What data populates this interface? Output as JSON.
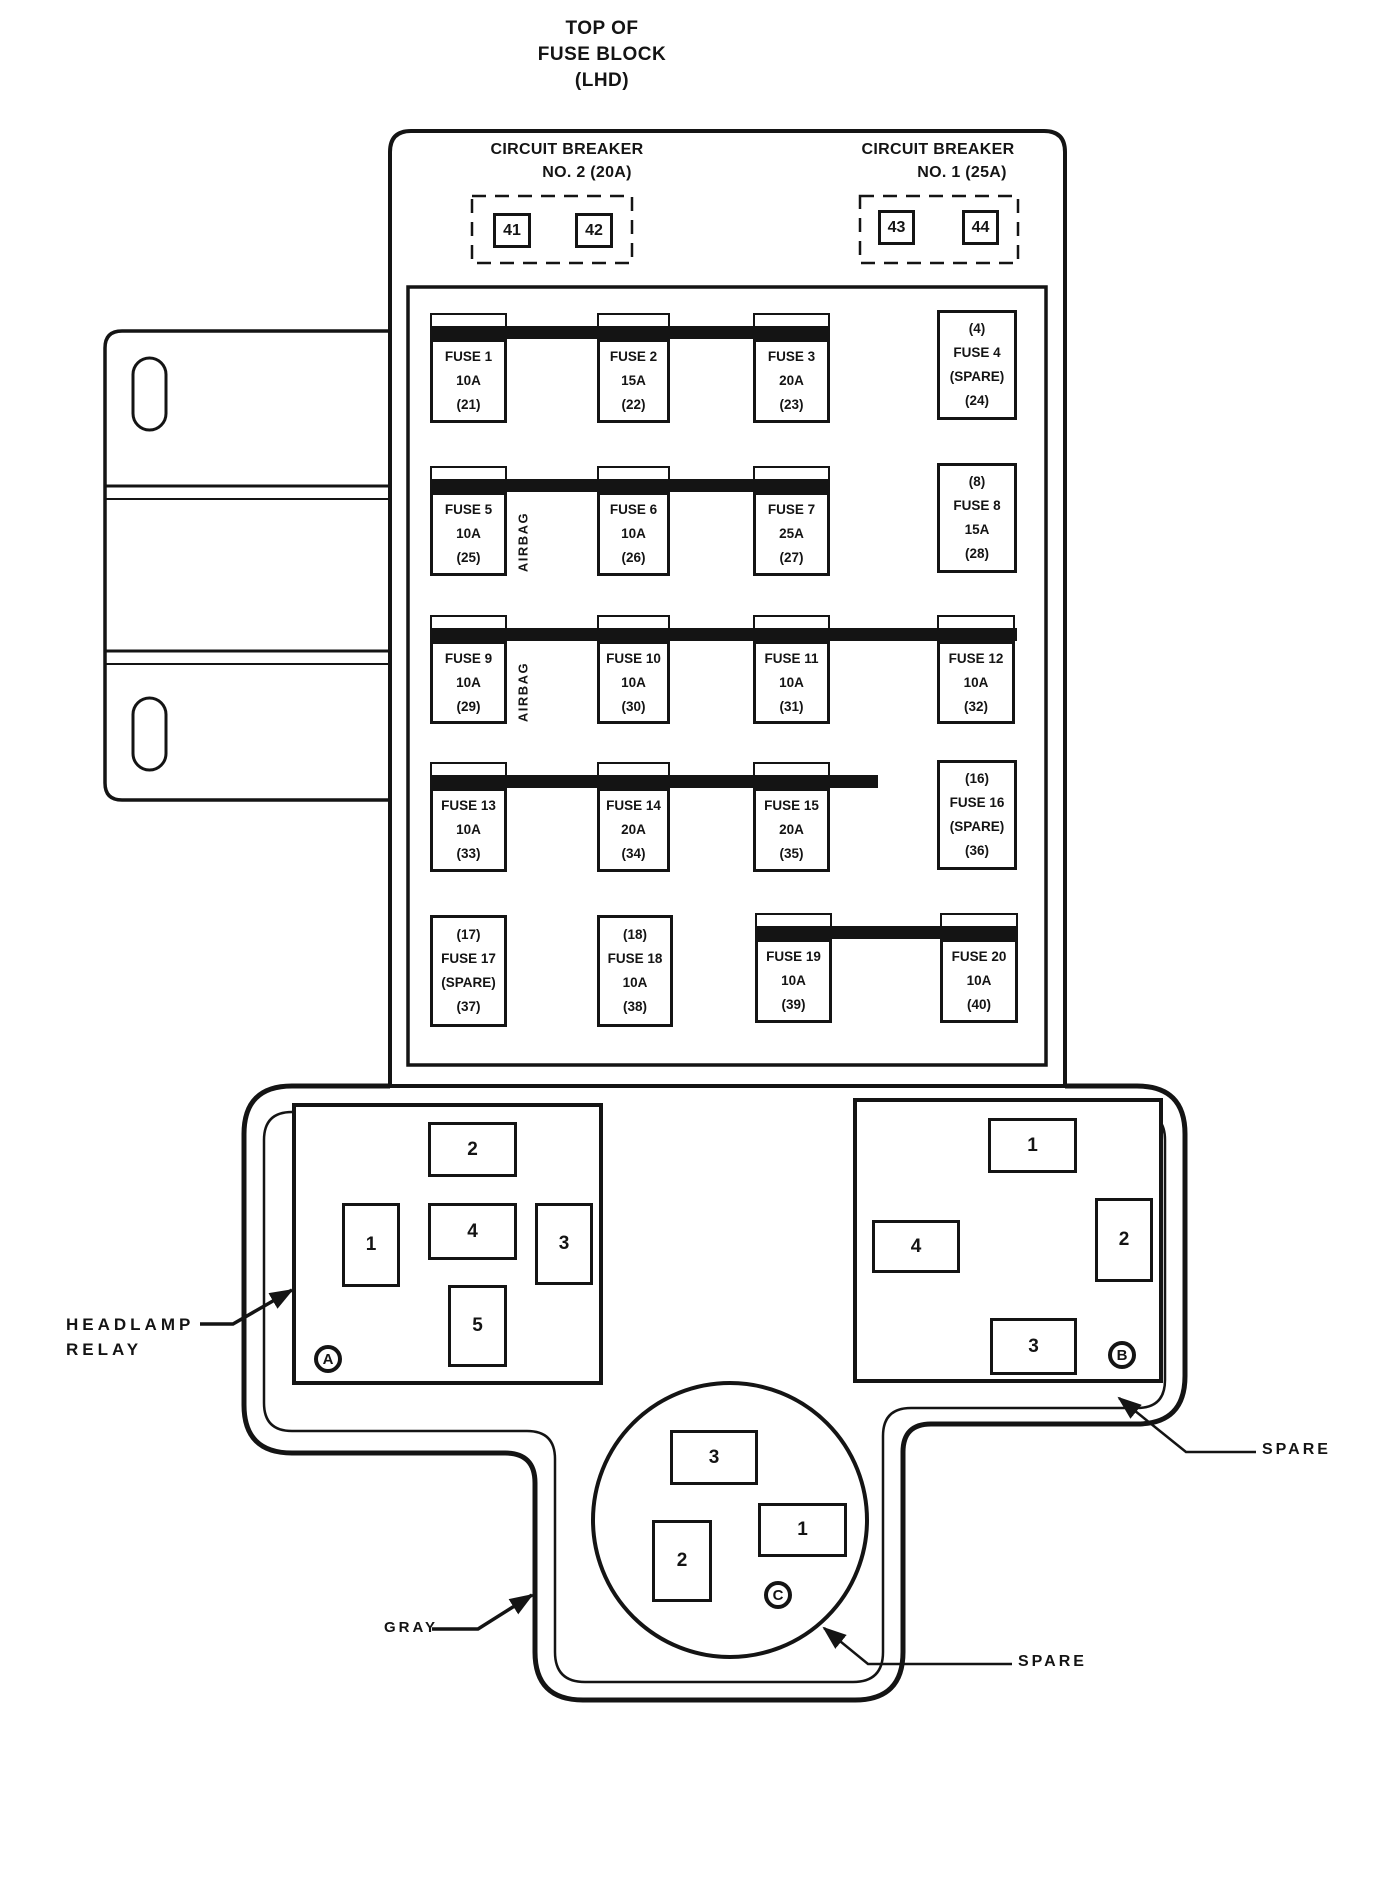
{
  "title": {
    "line1": "TOP OF",
    "line2": "FUSE BLOCK",
    "line3": "(LHD)"
  },
  "circuit_breaker_no2": {
    "name_line": "CIRCUIT BREAKER",
    "rating_line": "NO. 2  (20A)",
    "terminals": [
      "41",
      "42"
    ]
  },
  "circuit_breaker_no1": {
    "name_line": "CIRCUIT BREAKER",
    "rating_line": "NO. 1  (25A)",
    "terminals": [
      "43",
      "44"
    ]
  },
  "airbag_label_row2": "AIRBAG",
  "airbag_label_row3": "AIRBAG",
  "fuses": [
    {
      "lines": [
        "FUSE 1",
        "10A",
        "(21)"
      ]
    },
    {
      "lines": [
        "FUSE 2",
        "15A",
        "(22)"
      ]
    },
    {
      "lines": [
        "FUSE 3",
        "20A",
        "(23)"
      ]
    },
    {
      "lines": [
        "(4)",
        "FUSE 4",
        "(SPARE)",
        "(24)"
      ]
    },
    {
      "lines": [
        "FUSE 5",
        "10A",
        "(25)"
      ]
    },
    {
      "lines": [
        "FUSE 6",
        "10A",
        "(26)"
      ]
    },
    {
      "lines": [
        "FUSE 7",
        "25A",
        "(27)"
      ]
    },
    {
      "lines": [
        "(8)",
        "FUSE 8",
        "15A",
        "(28)"
      ]
    },
    {
      "lines": [
        "FUSE 9",
        "10A",
        "(29)"
      ]
    },
    {
      "lines": [
        "FUSE 10",
        "10A",
        "(30)"
      ]
    },
    {
      "lines": [
        "FUSE 11",
        "10A",
        "(31)"
      ]
    },
    {
      "lines": [
        "FUSE 12",
        "10A",
        "(32)"
      ]
    },
    {
      "lines": [
        "FUSE 13",
        "10A",
        "(33)"
      ]
    },
    {
      "lines": [
        "FUSE 14",
        "20A",
        "(34)"
      ]
    },
    {
      "lines": [
        "FUSE 15",
        "20A",
        "(35)"
      ]
    },
    {
      "lines": [
        "(16)",
        "FUSE 16",
        "(SPARE)",
        "(36)"
      ]
    },
    {
      "lines": [
        "(17)",
        "FUSE 17",
        "(SPARE)",
        "(37)"
      ]
    },
    {
      "lines": [
        "(18)",
        "FUSE 18",
        "10A",
        "(38)"
      ]
    },
    {
      "lines": [
        "FUSE 19",
        "10A",
        "(39)"
      ]
    },
    {
      "lines": [
        "FUSE 20",
        "10A",
        "(40)"
      ]
    }
  ],
  "connector_a": {
    "letter": "A",
    "pins": [
      "1",
      "2",
      "3",
      "4",
      "5"
    ]
  },
  "connector_b": {
    "letter": "B",
    "pins": [
      "1",
      "2",
      "3",
      "4"
    ]
  },
  "connector_c": {
    "letter": "C",
    "pins": [
      "1",
      "2",
      "3"
    ]
  },
  "callouts": {
    "headlamp_relay": {
      "line1": "HEADLAMP",
      "line2": "RELAY"
    },
    "gray": "GRAY",
    "spare_connector_b": "SPARE",
    "spare_connector_c": "SPARE"
  },
  "colors": {
    "ink": "#141414",
    "paper": "#ffffff"
  }
}
